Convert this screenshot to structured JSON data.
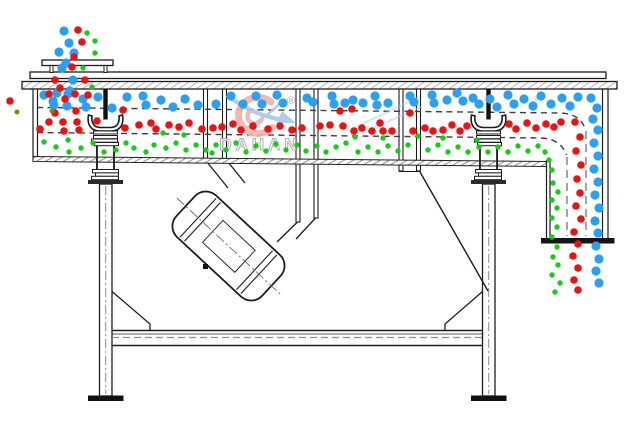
{
  "page": {
    "width": 638,
    "height": 428,
    "background": "#ffffff"
  },
  "watermark": {
    "brand": "DAHAN",
    "registered_mark": "®",
    "secondary_registered_mark": "®"
  },
  "colors": {
    "line": "#1c1c1c",
    "hatch_gray": "#8e8e8e",
    "deck_dash": "#3d3d3d",
    "chute_dash_gray": "#8e8e8e",
    "watermark_gray": "#a9a9a9",
    "watermark_pink": "#f1b2a9",
    "watermark_blue": "#a9c8e9",
    "particle_blue": "#2d9ff0",
    "particle_red": "#e81414",
    "particle_green": "#16cd16",
    "particle_olive": "#8f8300"
  },
  "particles": {
    "blue": {
      "color": "#2d9ff0",
      "radius": 4.6,
      "points": [
        [
          64,
          31
        ],
        [
          69,
          43
        ],
        [
          59,
          52
        ],
        [
          74,
          53
        ],
        [
          66,
          63
        ],
        [
          62,
          68
        ],
        [
          73,
          80
        ],
        [
          70,
          91
        ],
        [
          57,
          93
        ],
        [
          44,
          95
        ],
        [
          53,
          101
        ],
        [
          54,
          105
        ],
        [
          68,
          94
        ],
        [
          67,
          106
        ],
        [
          83,
          99
        ],
        [
          86,
          107
        ],
        [
          98,
          97
        ],
        [
          112,
          108
        ],
        [
          127,
          97
        ],
        [
          143,
          96
        ],
        [
          146,
          105
        ],
        [
          161,
          100
        ],
        [
          173,
          107
        ],
        [
          185,
          99
        ],
        [
          198,
          105
        ],
        [
          216,
          104
        ],
        [
          231,
          96
        ],
        [
          243,
          104
        ],
        [
          256,
          96
        ],
        [
          262,
          104
        ],
        [
          277,
          95
        ],
        [
          283,
          103
        ],
        [
          307,
          98
        ],
        [
          313,
          102
        ],
        [
          332,
          96
        ],
        [
          334,
          104
        ],
        [
          345,
          103
        ],
        [
          353,
          100
        ],
        [
          363,
          103
        ],
        [
          375,
          96
        ],
        [
          377,
          105
        ],
        [
          388,
          103
        ],
        [
          410,
          96
        ],
        [
          414,
          102
        ],
        [
          432,
          95
        ],
        [
          434,
          103
        ],
        [
          447,
          100
        ],
        [
          457,
          93
        ],
        [
          463,
          101
        ],
        [
          473,
          98
        ],
        [
          479,
          104
        ],
        [
          490,
          99
        ],
        [
          497,
          107
        ],
        [
          508,
          95
        ],
        [
          514,
          104
        ],
        [
          524,
          99
        ],
        [
          533,
          106
        ],
        [
          541,
          96
        ],
        [
          551,
          104
        ],
        [
          562,
          98
        ],
        [
          570,
          106
        ],
        [
          578,
          97
        ],
        [
          591,
          98
        ],
        [
          597,
          108
        ],
        [
          593,
          119
        ],
        [
          598,
          130
        ],
        [
          594,
          143
        ],
        [
          598,
          156
        ],
        [
          594,
          169
        ],
        [
          598,
          182
        ],
        [
          595,
          195
        ],
        [
          599,
          208
        ],
        [
          595,
          221
        ],
        [
          598,
          233
        ],
        [
          596,
          246
        ],
        [
          599,
          259
        ],
        [
          596,
          271
        ],
        [
          599,
          283
        ]
      ]
    },
    "red": {
      "color": "#e81414",
      "radius": 3.8,
      "points": [
        [
          78,
          30
        ],
        [
          82,
          42
        ],
        [
          74,
          57
        ],
        [
          72,
          67
        ],
        [
          55,
          80
        ],
        [
          85,
          80
        ],
        [
          60,
          88
        ],
        [
          49,
          94
        ],
        [
          65,
          99
        ],
        [
          75,
          94
        ],
        [
          88,
          95
        ],
        [
          10,
          101
        ],
        [
          55,
          113
        ],
        [
          76,
          111
        ],
        [
          49,
          122
        ],
        [
          40,
          129
        ],
        [
          63,
          122
        ],
        [
          64,
          131
        ],
        [
          77,
          122
        ],
        [
          79,
          130
        ],
        [
          97,
          121
        ],
        [
          123,
          110
        ],
        [
          125,
          128
        ],
        [
          139,
          125
        ],
        [
          151,
          123
        ],
        [
          156,
          129
        ],
        [
          169,
          125
        ],
        [
          179,
          127
        ],
        [
          189,
          123
        ],
        [
          202,
          129
        ],
        [
          213,
          128
        ],
        [
          222,
          127
        ],
        [
          233,
          124
        ],
        [
          241,
          130
        ],
        [
          253,
          126
        ],
        [
          268,
          129
        ],
        [
          280,
          126
        ],
        [
          292,
          130
        ],
        [
          302,
          128
        ],
        [
          320,
          126
        ],
        [
          330,
          125
        ],
        [
          340,
          111
        ],
        [
          343,
          126
        ],
        [
          352,
          109
        ],
        [
          354,
          131
        ],
        [
          362,
          128
        ],
        [
          372,
          131
        ],
        [
          380,
          123
        ],
        [
          383,
          131
        ],
        [
          392,
          131
        ],
        [
          410,
          113
        ],
        [
          413,
          131
        ],
        [
          425,
          128
        ],
        [
          433,
          131
        ],
        [
          443,
          130
        ],
        [
          452,
          125
        ],
        [
          460,
          131
        ],
        [
          467,
          126
        ],
        [
          509,
          124
        ],
        [
          516,
          129
        ],
        [
          527,
          123
        ],
        [
          536,
          128
        ],
        [
          546,
          124
        ],
        [
          554,
          127
        ],
        [
          561,
          122
        ],
        [
          575,
          122
        ],
        [
          580,
          137
        ],
        [
          576,
          151
        ],
        [
          581,
          165
        ],
        [
          577,
          179
        ],
        [
          580,
          193
        ],
        [
          576,
          206
        ],
        [
          581,
          219
        ],
        [
          574,
          232
        ],
        [
          578,
          244
        ],
        [
          573,
          256
        ],
        [
          578,
          268
        ],
        [
          574,
          280
        ],
        [
          578,
          290
        ]
      ]
    },
    "green": {
      "color": "#16cd16",
      "radius": 2.7,
      "points": [
        [
          87,
          33
        ],
        [
          95,
          41
        ],
        [
          95,
          53
        ],
        [
          83,
          68
        ],
        [
          92,
          87
        ],
        [
          44,
          142
        ],
        [
          56,
          147
        ],
        [
          68,
          140
        ],
        [
          69,
          152
        ],
        [
          81,
          148
        ],
        [
          93,
          143
        ],
        [
          104,
          152
        ],
        [
          116,
          150
        ],
        [
          126,
          143
        ],
        [
          134,
          148
        ],
        [
          146,
          152
        ],
        [
          154,
          145
        ],
        [
          163,
          133
        ],
        [
          166,
          148
        ],
        [
          176,
          143
        ],
        [
          184,
          135
        ],
        [
          186,
          150
        ],
        [
          196,
          145
        ],
        [
          206,
          150
        ],
        [
          212,
          153
        ],
        [
          216,
          145
        ],
        [
          226,
          150
        ],
        [
          236,
          143
        ],
        [
          246,
          152
        ],
        [
          256,
          146
        ],
        [
          266,
          151
        ],
        [
          276,
          144
        ],
        [
          286,
          150
        ],
        [
          297,
          145
        ],
        [
          306,
          151
        ],
        [
          317,
          146
        ],
        [
          326,
          152
        ],
        [
          336,
          147
        ],
        [
          346,
          143
        ],
        [
          355,
          137
        ],
        [
          358,
          152
        ],
        [
          368,
          147
        ],
        [
          378,
          152
        ],
        [
          383,
          138
        ],
        [
          388,
          146
        ],
        [
          398,
          151
        ],
        [
          408,
          145
        ],
        [
          418,
          136
        ],
        [
          428,
          150
        ],
        [
          438,
          145
        ],
        [
          443,
          138
        ],
        [
          448,
          152
        ],
        [
          458,
          147
        ],
        [
          468,
          152
        ],
        [
          477,
          140
        ],
        [
          479,
          147
        ],
        [
          488,
          152
        ],
        [
          498,
          147
        ],
        [
          508,
          152
        ],
        [
          518,
          146
        ],
        [
          528,
          151
        ],
        [
          538,
          146
        ],
        [
          545,
          152
        ],
        [
          549,
          160
        ],
        [
          552,
          170
        ],
        [
          553,
          183
        ],
        [
          558,
          192
        ],
        [
          552,
          200
        ],
        [
          557,
          208
        ],
        [
          552,
          218
        ],
        [
          557,
          227
        ],
        [
          552,
          237
        ],
        [
          557,
          247
        ],
        [
          553,
          257
        ],
        [
          558,
          265
        ],
        [
          552,
          275
        ],
        [
          560,
          283
        ],
        [
          555,
          292
        ]
      ]
    },
    "olive": {
      "color": "#8f8300",
      "radius": 2.5,
      "points": [
        [
          17,
          112
        ],
        [
          52,
          111
        ]
      ]
    }
  }
}
